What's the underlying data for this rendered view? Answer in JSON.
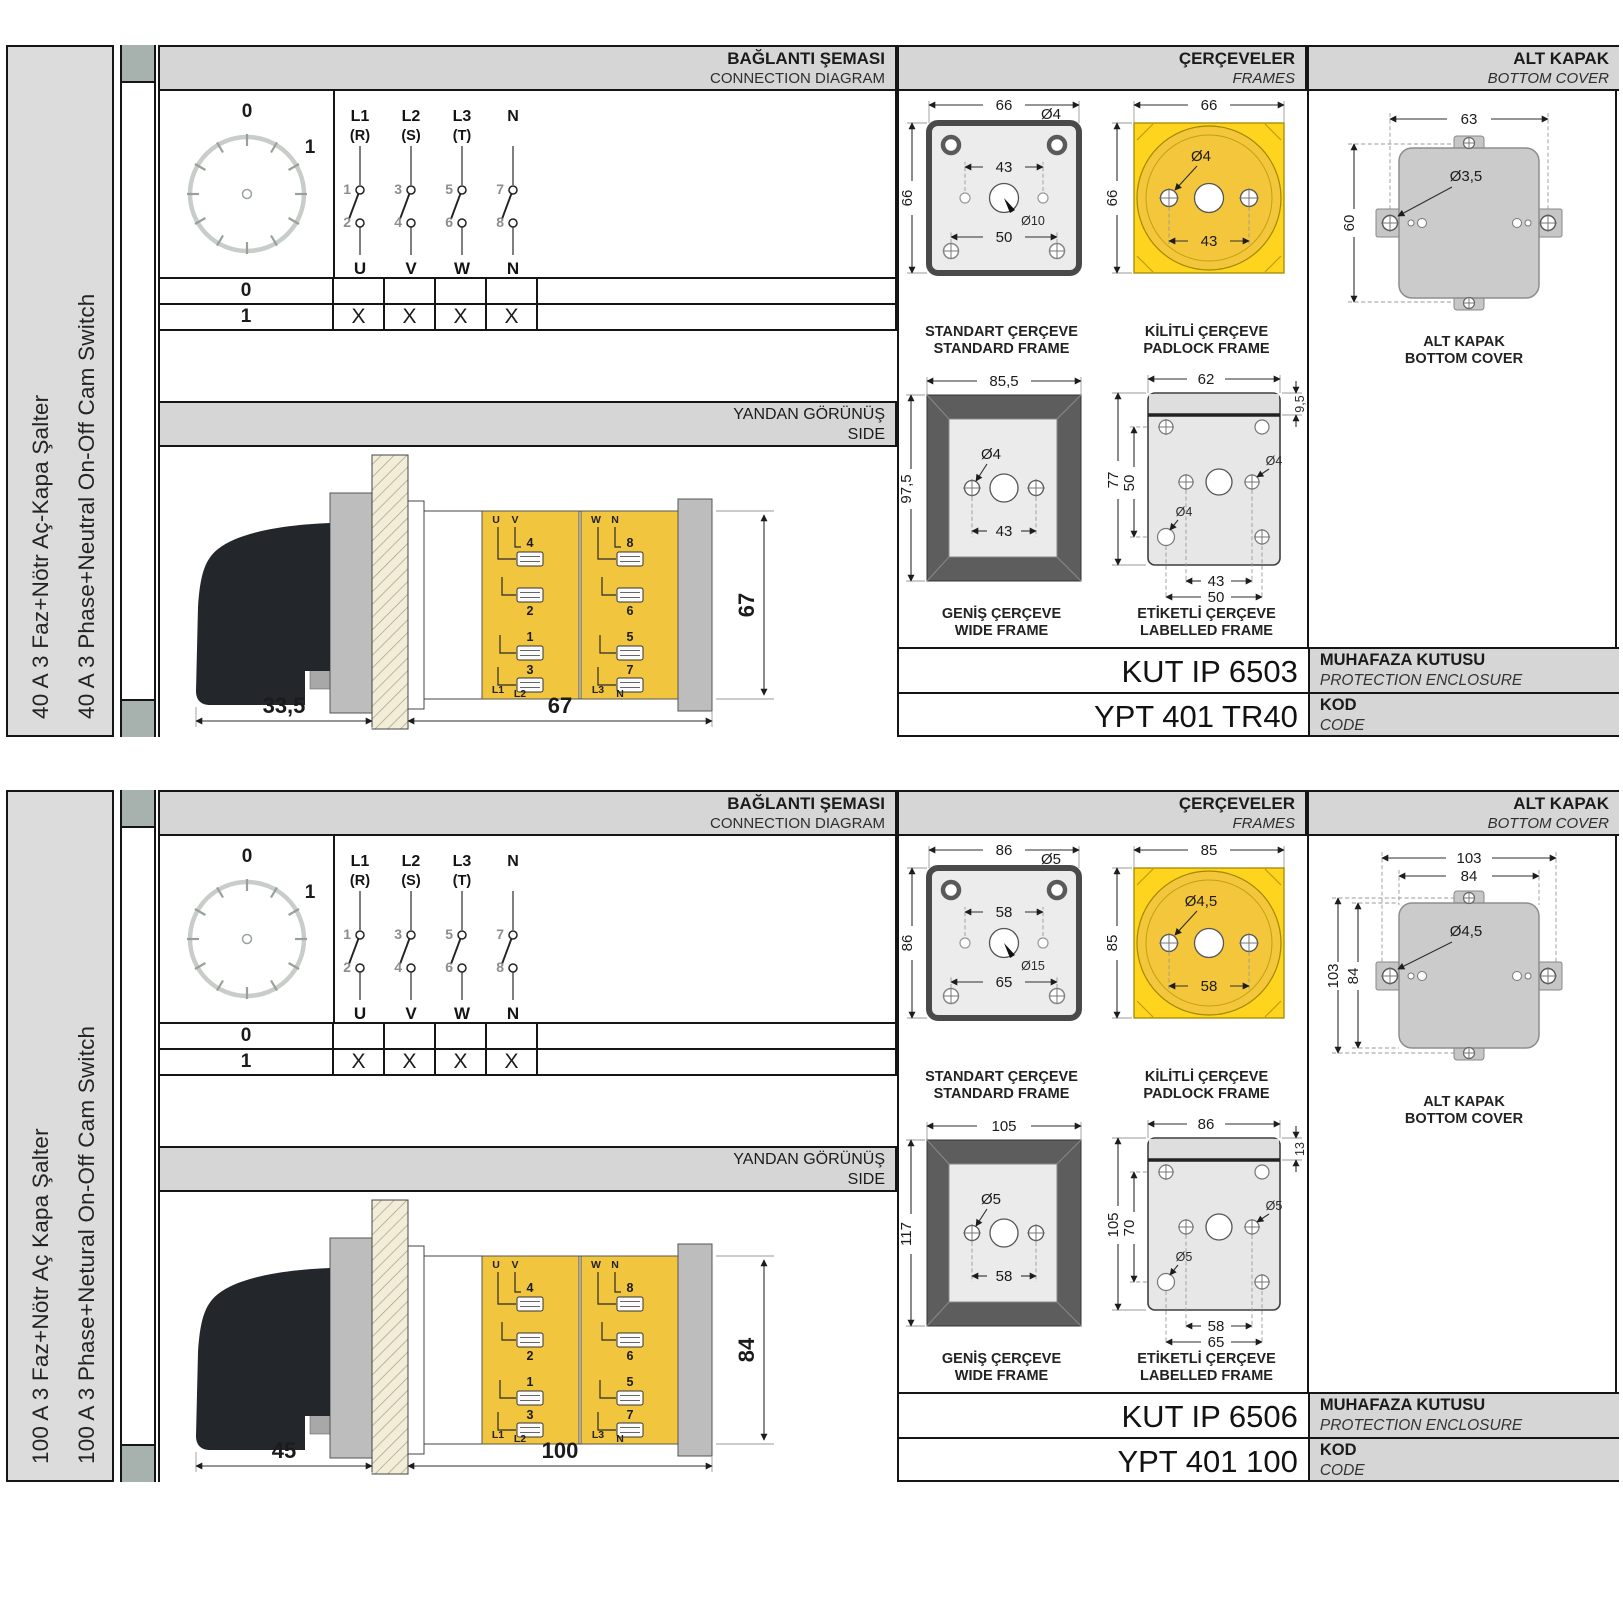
{
  "headers": {
    "connection_tr": "BAĞLANTI ŞEMASI",
    "connection_en": "CONNECTION DIAGRAM",
    "frames_tr": "ÇERÇEVELER",
    "frames_en": "FRAMES",
    "cover_tr": "ALT KAPAK",
    "cover_en": "BOTTOM COVER",
    "side_tr": "YANDAN GÖRÜNÜŞ",
    "side_en": "SIDE"
  },
  "diagram": {
    "dial": {
      "p0": "0",
      "p1": "1"
    },
    "poles": [
      {
        "a": "L1",
        "b": "(R)",
        "i": "1",
        "o": "2",
        "u": "U"
      },
      {
        "a": "L2",
        "b": "(S)",
        "i": "3",
        "o": "4",
        "u": "V"
      },
      {
        "a": "L3",
        "b": "(T)",
        "i": "5",
        "o": "6",
        "u": "W"
      },
      {
        "a": "N",
        "b": "",
        "i": "7",
        "o": "8",
        "u": "N"
      }
    ],
    "table": {
      "row0": {
        "label": "0",
        "cells": [
          "",
          "",
          "",
          ""
        ]
      },
      "row1": {
        "label": "1",
        "cells": [
          "X",
          "X",
          "X",
          "X"
        ]
      }
    }
  },
  "side_labels": {
    "u": "U",
    "v": "V",
    "w": "W",
    "n": "N",
    "t4": "4",
    "t2": "2",
    "t1": "1",
    "t3": "3",
    "t8": "8",
    "t6": "6",
    "t5": "5",
    "t7": "7",
    "l1": "L1",
    "l2": "L2",
    "l3": "L3",
    "nn": "N"
  },
  "frame_captions": {
    "standard_tr": "STANDART ÇERÇEVE",
    "standard_en": "STANDARD FRAME",
    "padlock_tr": "KİLİTLİ ÇERÇEVE",
    "padlock_en": "PADLOCK FRAME",
    "wide_tr": "GENİŞ ÇERÇEVE",
    "wide_en": "WIDE FRAME",
    "labelled_tr": "ETİKETLİ ÇERÇEVE",
    "labelled_en": "LABELLED FRAME",
    "cover_tr": "ALT KAPAK",
    "cover_en": "BOTTOM COVER"
  },
  "shared_labels": {
    "enclosure_tr": "MUHAFAZA KUTUSU",
    "enclosure_en": "PROTECTION ENCLOSURE",
    "kod_tr": "KOD",
    "kod_en": "CODE"
  },
  "colors": {
    "accent_yellow": "#f6c63c",
    "bright_yellow": "#ffd41f",
    "panel_gray": "#d6d6d6",
    "frame_dark": "#4f4f4f"
  },
  "panels": [
    {
      "title_tr": "40 A 3 Faz+Nötr Aç-Kapa Şalter",
      "title_en": "40 A 3 Phase+Neutral On-Off Cam Switch",
      "side_view": {
        "depth": "33,5",
        "width": "67",
        "height": "67"
      },
      "frames": {
        "standard": {
          "w": "66",
          "h": "66",
          "span_top": "43",
          "hole": "Ø4",
          "center": "Ø10",
          "span_bottom": "50"
        },
        "padlock": {
          "w": "66",
          "h": "66",
          "hole": "Ø4",
          "span": "43"
        },
        "wide": {
          "w": "85,5",
          "h": "97,5",
          "hole": "Ø4",
          "span": "43"
        },
        "labelled": {
          "w": "62",
          "strip": "9,5",
          "h": "77",
          "span_v": "50",
          "hole_a": "Ø4",
          "hole_b": "Ø4",
          "span1": "43",
          "span2": "50"
        }
      },
      "cover": {
        "w": "63",
        "h": "60",
        "hole": "Ø3,5"
      },
      "enclosure_code": "KUT IP 6503",
      "code": "YPT 401 TR40"
    },
    {
      "title_tr": "100 A 3 Faz+Nötr Aç Kapa Şalter",
      "title_en": "100 A 3 Phase+Netural On-Off Cam Switch",
      "side_view": {
        "depth": "45",
        "width": "100",
        "height": "84"
      },
      "frames": {
        "standard": {
          "w": "86",
          "h": "86",
          "span_top": "58",
          "hole": "Ø5",
          "center": "Ø15",
          "span_bottom": "65"
        },
        "padlock": {
          "w": "85",
          "h": "85",
          "hole": "Ø4,5",
          "span": "58"
        },
        "wide": {
          "w": "105",
          "h": "117",
          "hole": "Ø5",
          "span": "58"
        },
        "labelled": {
          "w": "86",
          "strip": "13",
          "h": "105",
          "span_v": "70",
          "hole_a": "Ø5",
          "hole_b": "Ø5",
          "span1": "58",
          "span2": "65"
        }
      },
      "cover": {
        "w1": "103",
        "w2": "84",
        "h1": "103",
        "h2": "84",
        "hole": "Ø4,5"
      },
      "enclosure_code": "KUT IP 6506",
      "code": "YPT 401 100"
    }
  ]
}
